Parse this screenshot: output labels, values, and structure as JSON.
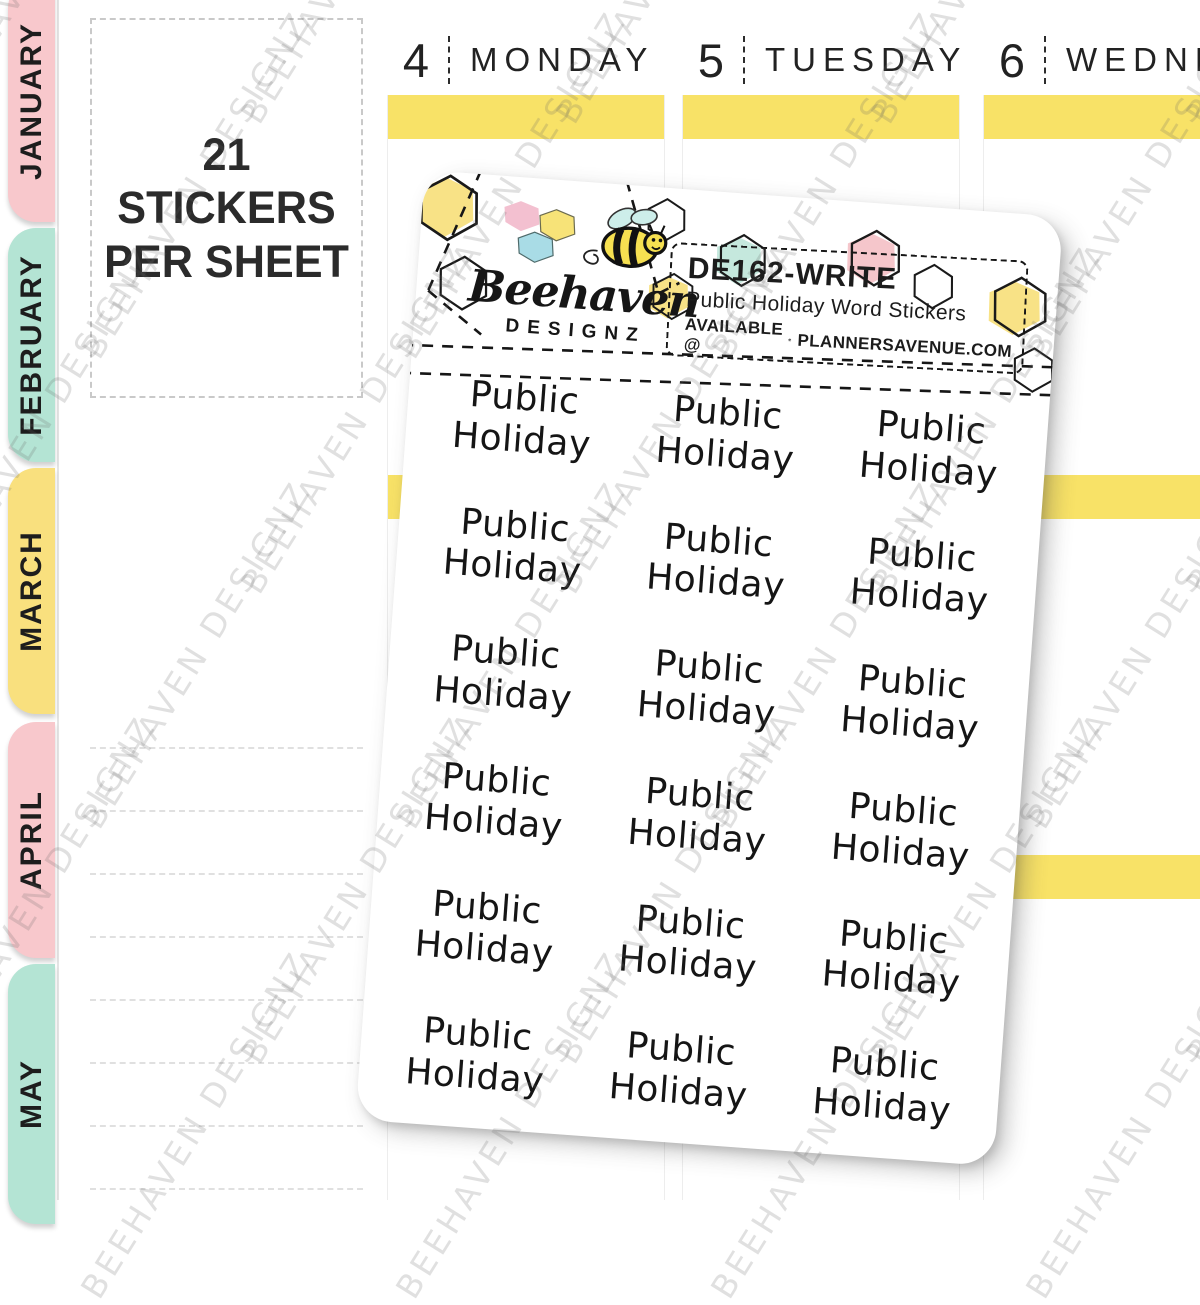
{
  "watermark": {
    "text": "BEEHAVEN DESIGNZ"
  },
  "sidebar": {
    "months": [
      {
        "label": "JANUARY",
        "color": "#f8c8cc"
      },
      {
        "label": "FEBRUARY",
        "color": "#b4e4d4"
      },
      {
        "label": "MARCH",
        "color": "#f9e07e"
      },
      {
        "label": "APRIL",
        "color": "#f8c8cc"
      },
      {
        "label": "MAY",
        "color": "#b4e4d4"
      }
    ]
  },
  "notes_panel": {
    "title_line1": "21 STICKERS",
    "title_line2": "PER SHEET"
  },
  "week_header": {
    "days": [
      {
        "num": "4",
        "name": "MONDAY"
      },
      {
        "num": "5",
        "name": "TUESDAY"
      },
      {
        "num": "6",
        "name": "WEDNESDAY"
      }
    ]
  },
  "sticker_sheet": {
    "brand": {
      "script": "Beehaven",
      "caps": "DESIGNZ"
    },
    "info_label": {
      "sku": "DE162-WRITE",
      "title": "Public Holiday Word Stickers",
      "available_prefix": "AVAILABLE @",
      "site": "PLANNERSAVENUE.COM"
    },
    "sticker_text": {
      "line1": "Public",
      "line2": "Holiday"
    },
    "grid": {
      "rows": 6,
      "columns": 3,
      "visible_stickers": 18
    }
  },
  "palette": {
    "tab_pink": "#f8c8cc",
    "tab_mint": "#b4e4d4",
    "tab_yellow": "#f9e07e",
    "highlight_yellow": "#f8e267",
    "hex_yellow": "#f8e286",
    "hex_pink": "#f5c6cb",
    "hex_teal": "#c5e8dd",
    "logo_hex_pink": "#f3c0d0",
    "logo_hex_yellow": "#f7e378",
    "logo_hex_blue": "#a9dce6",
    "bee_yellow": "#f6e051",
    "wing_teal": "#cdeeea",
    "watermark_gray": "#dedede",
    "ink": "#1a1a1a"
  }
}
